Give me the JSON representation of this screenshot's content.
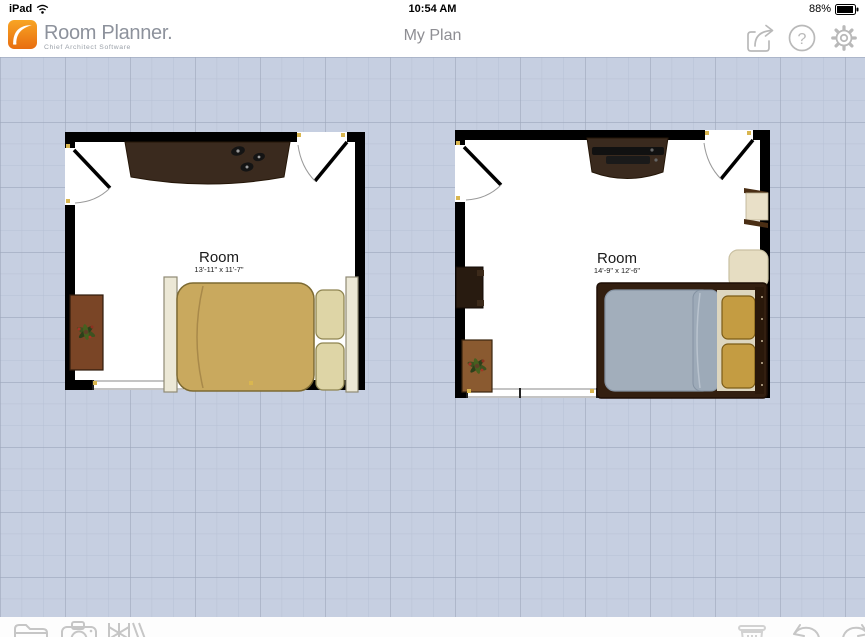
{
  "status_bar": {
    "device": "iPad",
    "time": "10:54 AM",
    "battery_percent": "88%",
    "icons": [
      "wifi-icon",
      "battery-icon"
    ]
  },
  "header": {
    "app_name": "Room Planner.",
    "app_subtitle": "Chief Architect Software",
    "page_title": "My Plan",
    "help_glyph": "?",
    "icons": [
      "share-icon",
      "help-icon",
      "settings-icon"
    ]
  },
  "canvas": {
    "rooms": [
      {
        "label": "Room",
        "dimensions": "13'-11\" x 11'-7\""
      },
      {
        "label": "Room",
        "dimensions": "14'-9\" x 12'-6\""
      }
    ]
  },
  "toolbar": {
    "left_icons": [
      "folder-icon",
      "camera-icon",
      "library-icon"
    ],
    "right_icons": [
      "trash-icon",
      "undo-icon",
      "redo-icon"
    ]
  },
  "colors": {
    "brand_orange": "#ee8018",
    "canvas_background": "#c6cfe1",
    "grid_minor": "#b6c0d4",
    "grid_major": "#9da7bb",
    "wall": "#000000",
    "bed_tan": "#c9a95e",
    "pillow_cream": "#ded5a6",
    "bed_gray": "#a2aebb",
    "sheet_cream": "#ddd6bf",
    "pillow_gold": "#c49c42",
    "wood_dark": "#3a2a1e",
    "wood_medium": "#8a5a30",
    "window_tick_tan": "#d9b650",
    "icon_gray": "#b9b9b9"
  }
}
